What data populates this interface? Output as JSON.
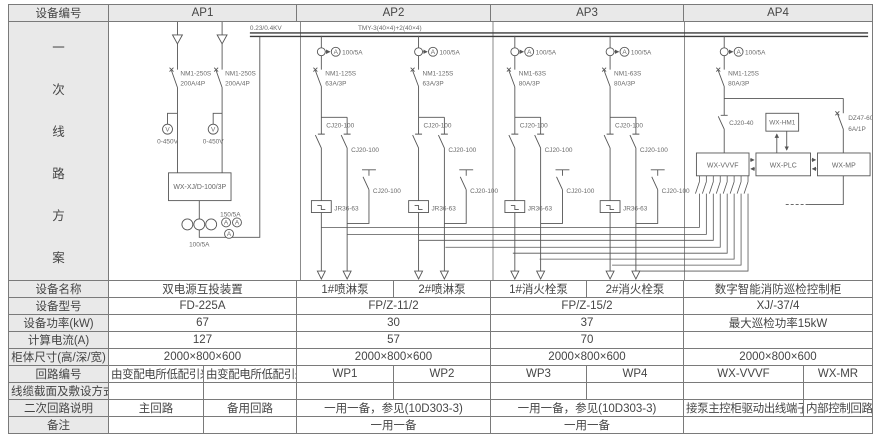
{
  "colors": {
    "header_bg": "#e9e9e9",
    "border": "#7a7a7a",
    "line_stroke": "#555555",
    "text": "#454545"
  },
  "header": {
    "device_no_label": "设备编号",
    "columns": [
      "AP1",
      "AP2",
      "AP3",
      "AP4"
    ]
  },
  "side": {
    "chars": [
      "一",
      "次",
      "线",
      "路",
      "方",
      "案"
    ]
  },
  "diagram": {
    "voltage_label": "0.23/0.4KV",
    "busbar_label": "TMY-3(40×4)+2(40×4)",
    "ap1": {
      "breaker1_model": "NM1-250S",
      "breaker1_rating": "200A/4P",
      "breaker2_model": "NM1-250S",
      "breaker2_rating": "200A/4P",
      "voltmeter_letter": "V",
      "volt_range1": "0-450V",
      "volt_range2": "0-450V",
      "ats_box": "WX-XJ/D-100/3P",
      "ct_ratio": "100/5A",
      "ammeter_ratio": "150/5A",
      "ammeter_letter": "A"
    },
    "branches": [
      {
        "x": 209,
        "ct": "100/5A",
        "meter": "A",
        "breaker_model": "NM1-125S",
        "breaker_rating": "63A/3P",
        "c1": "CJ20-100",
        "c2": "CJ20-100",
        "c3": "CJ20-100",
        "relay": "JR36-63"
      },
      {
        "x": 307,
        "ct": "100/5A",
        "meter": "A",
        "breaker_model": "NM1-125S",
        "breaker_rating": "63A/3P",
        "c1": "CJ20-100",
        "c2": "CJ20-100",
        "c3": "CJ20-100",
        "relay": "JR36-63"
      },
      {
        "x": 404,
        "ct": "100/5A",
        "meter": "A",
        "breaker_model": "NM1-63S",
        "breaker_rating": "80A/3P",
        "c1": "CJ20-100",
        "c2": "CJ20-100",
        "c3": "CJ20-100",
        "relay": "JR36-63"
      },
      {
        "x": 500,
        "ct": "100/5A",
        "meter": "A",
        "breaker_model": "NM1-63S",
        "breaker_rating": "80A/3P",
        "c1": "CJ20-100",
        "c2": "CJ20-100",
        "c3": "CJ20-100",
        "relay": "JR36-63"
      }
    ],
    "ap4": {
      "ct": "100/5A",
      "meter": "A",
      "breaker_model": "NM1-125S",
      "breaker_rating": "80A/3P",
      "contactor": "CJ20-40",
      "aux_breaker_model": "DZ47-60",
      "aux_breaker_rating": "6A/1P",
      "vvvf_box": "WX-VVVF",
      "plc_box": "WX-PLC",
      "mp_box": "WX-MP",
      "hmi_box": "WX-HM1"
    },
    "fan_lines": [
      {
        "fx": 590,
        "y": 207,
        "dest": 209
      },
      {
        "fx": 597,
        "y": 214,
        "dest": 235
      },
      {
        "fx": 604,
        "y": 220,
        "dest": 307
      },
      {
        "fx": 611,
        "y": 227,
        "dest": 334
      },
      {
        "fx": 618,
        "y": 233,
        "dest": 402
      },
      {
        "fx": 625,
        "y": 239,
        "dest": 429
      },
      {
        "fx": 632,
        "y": 245,
        "dest": 502
      },
      {
        "fx": 639,
        "y": 251,
        "dest": 525
      }
    ]
  },
  "table": {
    "rows": [
      {
        "label": "设备名称",
        "cells": [
          {
            "t": "双电源互投装置"
          },
          {
            "t": "1#喷淋泵"
          },
          {
            "t": "2#喷淋泵"
          },
          {
            "t": "1#消火栓泵"
          },
          {
            "t": "2#消火栓泵"
          },
          {
            "t": "数字智能消防巡检控制柜"
          }
        ]
      },
      {
        "label": "设备型号",
        "cells": [
          {
            "t": "FD-225A"
          },
          {
            "t": "FP/Z-11/2"
          },
          {
            "t": "FP/Z-15/2"
          },
          {
            "t": "XJ/-37/4"
          }
        ]
      },
      {
        "label": "设备功率(kW)",
        "cells": [
          {
            "t": "67"
          },
          {
            "t": "30"
          },
          {
            "t": "37"
          },
          {
            "t": "最大巡检功率15kW"
          }
        ]
      },
      {
        "label": "计算电流(A)",
        "cells": [
          {
            "t": "127"
          },
          {
            "t": "57"
          },
          {
            "t": "70"
          },
          {
            "t": ""
          }
        ]
      },
      {
        "label": "柜体尺寸(高/深/宽)",
        "cells": [
          {
            "t": "2000×800×600"
          },
          {
            "t": "2000×800×600"
          },
          {
            "t": "2000×800×600"
          },
          {
            "t": "2000×800×600"
          }
        ]
      },
      {
        "label": "回路编号",
        "cells": [
          {
            "t": "由变配电所低配引来"
          },
          {
            "t": "由变配电所低配引来"
          },
          {
            "t": "WP1"
          },
          {
            "t": "WP2"
          },
          {
            "t": "WP3"
          },
          {
            "t": "WP4"
          },
          {
            "t": "WX-VVVF"
          },
          {
            "t": "WX-MR"
          }
        ]
      },
      {
        "label": "线缆截面及敷设方式",
        "cells": [
          {
            "t": ""
          },
          {
            "t": ""
          },
          {
            "t": ""
          },
          {
            "t": ""
          },
          {
            "t": ""
          },
          {
            "t": ""
          },
          {
            "t": ""
          },
          {
            "t": ""
          }
        ]
      },
      {
        "label": "二次回路说明",
        "cells": [
          {
            "t": "主回路"
          },
          {
            "t": "备用回路"
          },
          {
            "t": "一用一备，参见(10D303-3)"
          },
          {
            "t": "一用一备，参见(10D303-3)"
          },
          {
            "t": "接泵主控柜驱动出线端子"
          },
          {
            "t": "内部控制回路"
          }
        ]
      },
      {
        "label": "备注",
        "cells": [
          {
            "t": ""
          },
          {
            "t": ""
          },
          {
            "t": "一用一备"
          },
          {
            "t": "一用一备"
          },
          {
            "t": ""
          }
        ]
      }
    ]
  }
}
